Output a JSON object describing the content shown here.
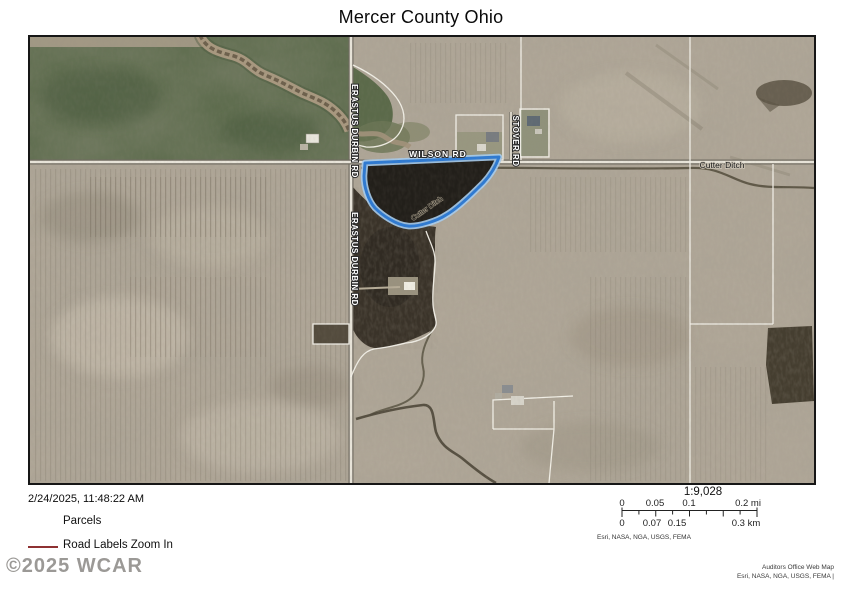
{
  "title": "Mercer County Ohio",
  "map": {
    "labels": {
      "wilson_rd": "WILSON RD",
      "erastus_durbin_rd_north": "ERASTUS DURBIN RD",
      "erastus_durbin_rd_south": "ERASTUS DURBIN RD",
      "stover_rd": "STOVER RD",
      "cutter_ditch": "Cutter Ditch",
      "cutter_ditch_diagonal": "Cutter Ditch"
    },
    "selected_parcel_color": "#2e7ad2"
  },
  "footer": {
    "timestamp": "2/24/2025, 11:48:22 AM",
    "legend": {
      "parcels_label": "Parcels",
      "road_labels_label": "Road Labels Zoom In",
      "road_symbol_color": "#8e3132"
    },
    "watermark": "©2025 WCAR",
    "scale": {
      "ratio": "1:9,028",
      "mi": [
        "0",
        "0.05",
        "0.1",
        "0.2 mi"
      ],
      "km": [
        "0",
        "0.07",
        "0.15",
        "0.3 km"
      ],
      "attribution": "Esri, NASA, NGA, USGS, FEMA"
    },
    "credits": [
      "Auditors Office Web Map",
      "Esri, NASA, NGA, USGS, FEMA |"
    ]
  }
}
